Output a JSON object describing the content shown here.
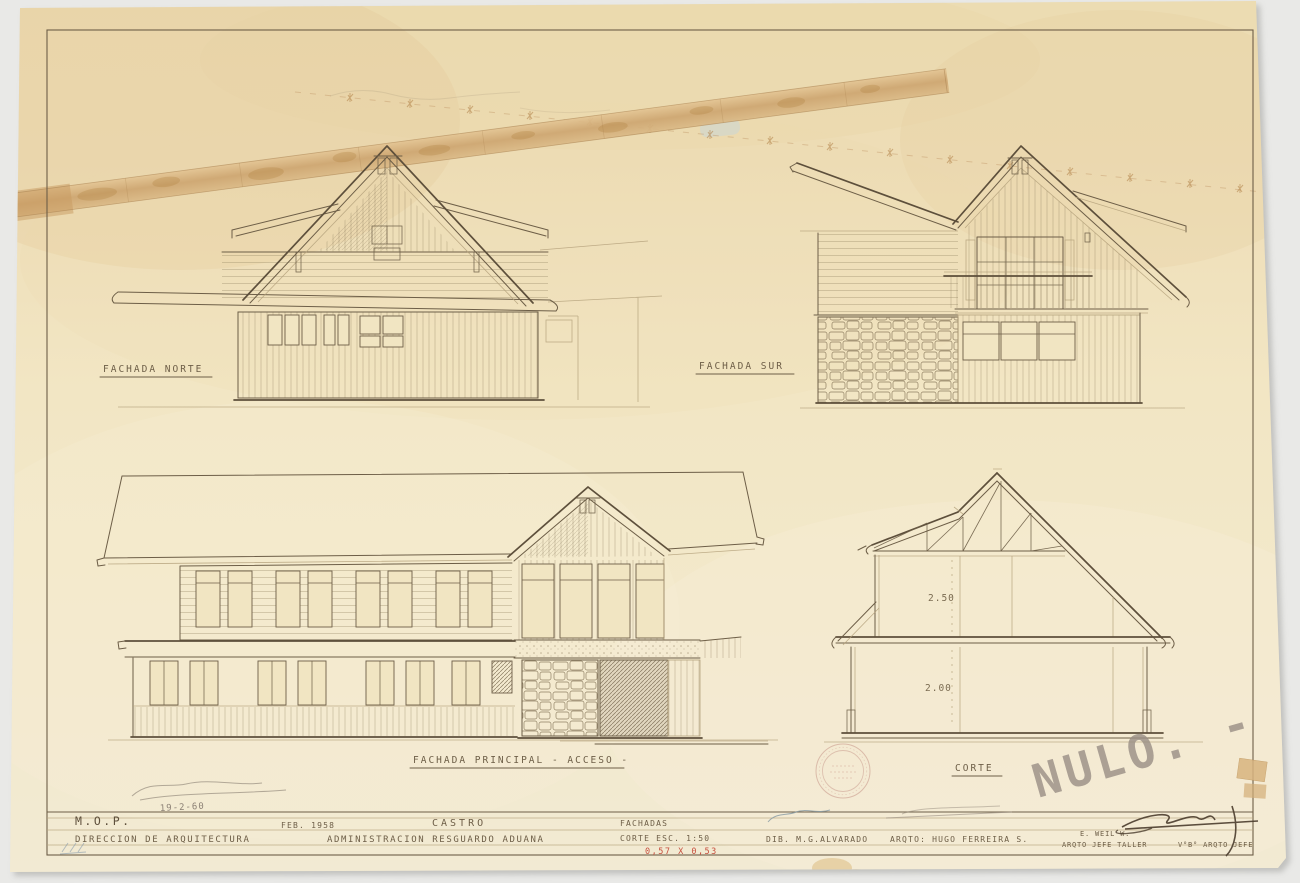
{
  "sheet": {
    "drawing_labels": {
      "north_elevation": "FACHADA NORTE",
      "south_elevation": "FACHADA SUR",
      "main_elevation": "FACHADA PRINCIPAL - ACCESO -",
      "section": "CORTE"
    },
    "section_dimensions": {
      "upper_floor_height": "2.50",
      "ground_floor_height": "2.00"
    },
    "title_block": {
      "agency": "M.O.P.",
      "department": "DIRECCION DE ARQUITECTURA",
      "date": "FEB. 1958",
      "location": "CASTRO",
      "project": "ADMINISTRACION RESGUARDO ADUANA",
      "content": "FACHADAS",
      "scale": "CORTE ESC. 1:50",
      "sheet_size": "0,57 X 0,53",
      "drafter": "DIB. M.G.ALVARADO",
      "architect": "ARQTO: HUGO FERREIRA S.",
      "chief_name": "E. WEIL W.",
      "chief_title": "ARQTO JEFE TALLER",
      "approval": "V°B° ARQTO JEFE"
    },
    "handwritten": {
      "void_note": "NULO. -",
      "pencil_date": "19-2-60"
    },
    "colors": {
      "paper": "#f1e5c2",
      "ink": "#6d5e47",
      "red_note": "#c7503e",
      "pencil": "#8d8276",
      "tape": "#d2ad79"
    }
  }
}
